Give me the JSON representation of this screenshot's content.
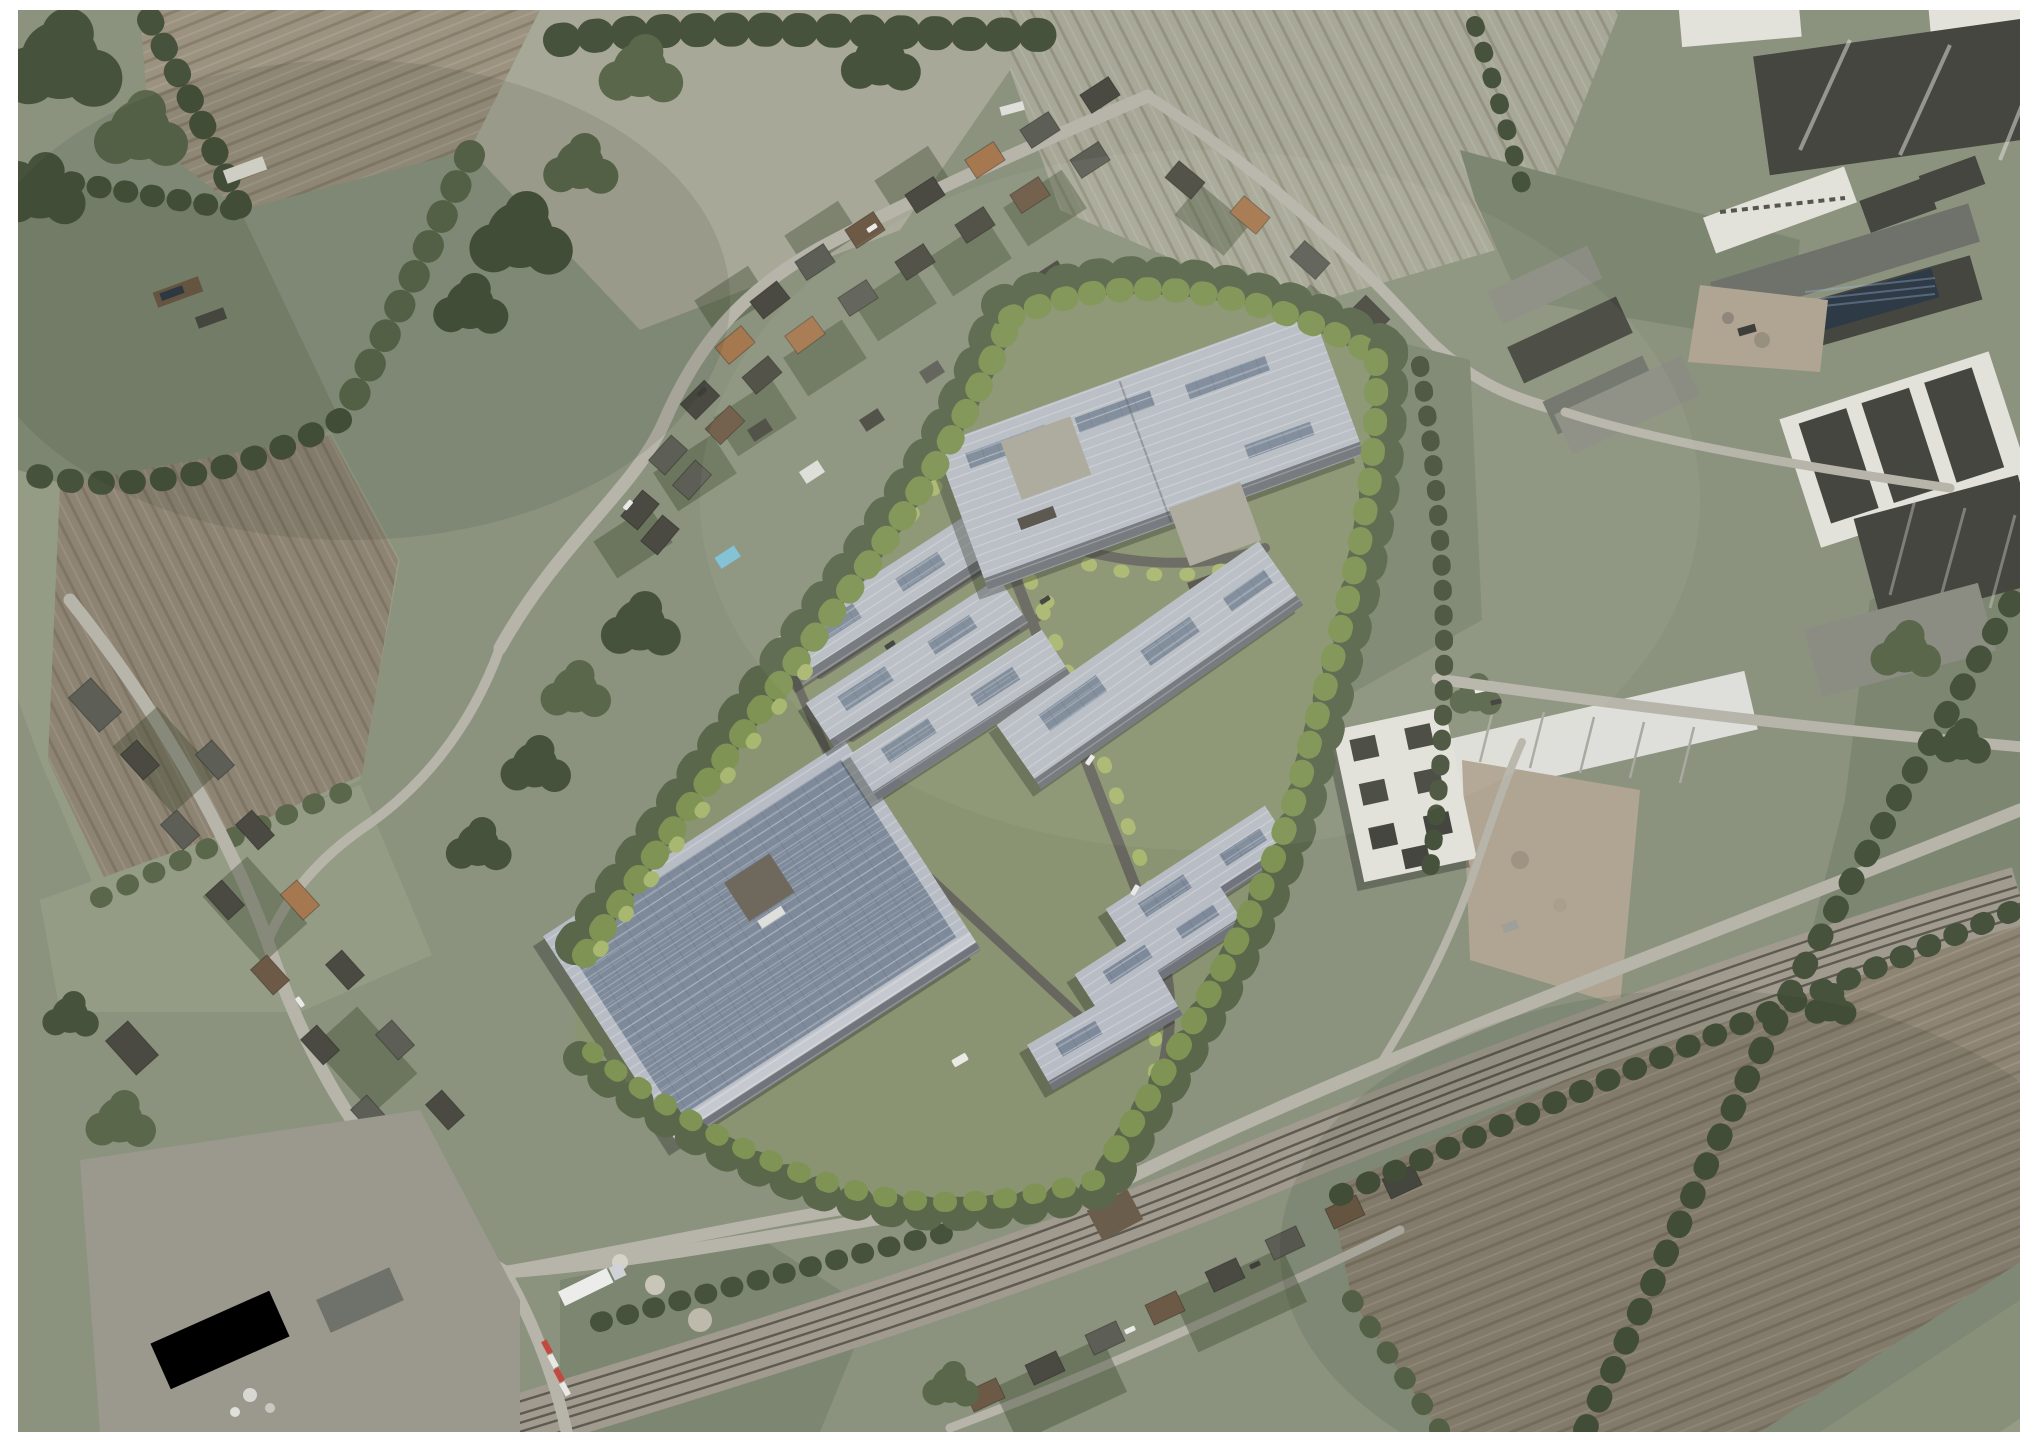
{
  "image": {
    "alt": "Oblique aerial photomontage: a proposed business park of light-grey warehouse units with rooftop solar panels, enclosed by a landscaped tree buffer, set between a village street (north-west), an existing industrial estate (east), and a railway line with ploughed farmland (south). The photo has a plain white border."
  },
  "frame": {
    "background": "#ffffff"
  },
  "palette": {
    "frame_white": "#ffffff",
    "land_base": "#8b937f",
    "pasture_green": "#7d8670",
    "pasture_light": "#959c86",
    "field_pale": "#a7a897",
    "field_plow": "#9c9280",
    "field_plow_dark": "#8e8474",
    "site_grass": "#8a9472",
    "tree_dark": "#47523c",
    "tree_mid": "#5a674b",
    "tree_light": "#7f9355",
    "tree_accent": "#a9b871",
    "road_light": "#b7b4aa",
    "road_dark": "#67675f",
    "rail_ballast": "#a09b8e",
    "rail_line": "#5e5a51",
    "roof_render": "#b8bdc5",
    "roof_render_dark": "#99a0ab",
    "solar_panel": "#7e8a9a",
    "solar_dark": "#2f3a47",
    "roof_dark": "#45463f",
    "roof_grey": "#6f726a",
    "roof_grey_light": "#8b8d83",
    "roof_brown": "#6d5a46",
    "roof_orange": "#a57850",
    "building_white": "#e2e1da",
    "dirt_yard": "#b0a592",
    "water_blue": "#7ec0d4"
  },
  "scene": {
    "development": {
      "row_unit_count": 7,
      "large_warehouse_count": 2,
      "roof_style": "light grey standing-seam with solar PV strips",
      "perimeter": "dense green tree buffer",
      "internal_features": [
        "estate roads",
        "young street trees",
        "loading yards",
        "site access to southern boundary road"
      ]
    },
    "context": {
      "village_street_housing": "north-west",
      "existing_industrial_estate": "east",
      "railway_corridor": "south",
      "ploughed_fields": [
        "north-west",
        "south-east"
      ],
      "level_crossing_markings": "bottom-left",
      "articulated_lorry": "bottom-left yard"
    }
  }
}
